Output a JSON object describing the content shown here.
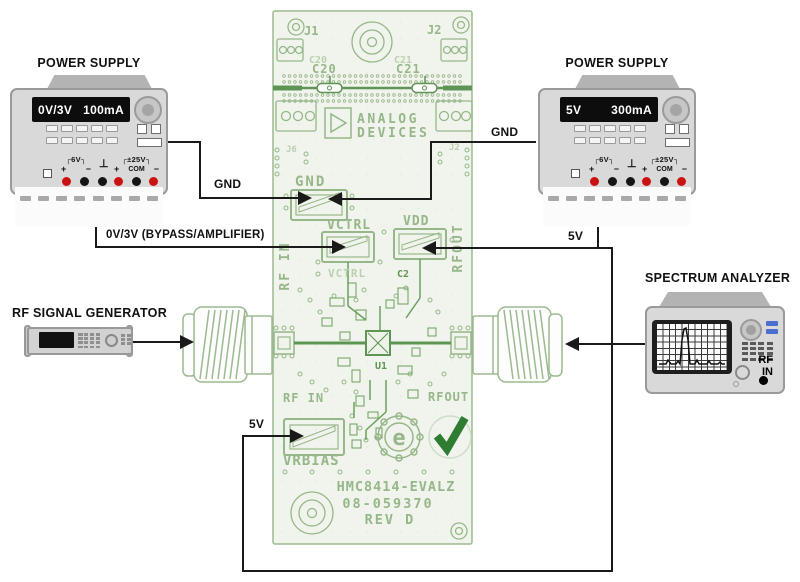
{
  "ps_left": {
    "title": "POWER SUPPLY",
    "voltage": "0V/3V",
    "current": "100mA"
  },
  "ps_right": {
    "title": "POWER SUPPLY",
    "voltage": "5V",
    "current": "300mA"
  },
  "terminals": {
    "six_v": "┌6V┐",
    "plus": "+",
    "minus": "−",
    "ground": "⊥",
    "pm_25v": "┌±25V┐",
    "com": "COM"
  },
  "rf_generator": {
    "title": "RF SIGNAL GENERATOR"
  },
  "spectrum_analyzer": {
    "title": "SPECTRUM ANALYZER",
    "rf": "RF",
    "in": "IN"
  },
  "wire_labels": {
    "gnd_left": "GND",
    "gnd_right": "GND",
    "vctrl_feed": "0V/3V (BYPASS/AMPLIFIER)",
    "vdd_feed": "5V",
    "vrbias_feed": "5V"
  },
  "pcb": {
    "j1": "J1",
    "j2": "J2",
    "c20": "C20",
    "c21": "C21",
    "j6": "J6",
    "j2_small": "J2",
    "brand_line1": "ANALOG",
    "brand_line2": "DEVICES",
    "gnd": "GND",
    "vctrl": "VCTRL",
    "vctrl_ghost": "VCTRL",
    "vdd": "VDD",
    "c2": "C2",
    "rf_in_side": "RF IN",
    "rf_out_side": "RFOUT",
    "u1": "U1",
    "rf_in": "RF IN",
    "rf_out": "RFOUT",
    "vrbias": "VRBIAS",
    "e_mark": "e",
    "part_number": "HMC8414-EVALZ",
    "assembly_number": "08-059370",
    "revision": "REV D"
  },
  "colors": {
    "wire": "#1a1a1a",
    "silk": "#96b789",
    "silk_dark": "#5f9554",
    "board_fill": "#f1f4ec",
    "check_green": "#2e7d32",
    "terminal_red": "#cc1111",
    "terminal_black": "#151515",
    "analyzer_button_blue": "#4a6fd0"
  }
}
